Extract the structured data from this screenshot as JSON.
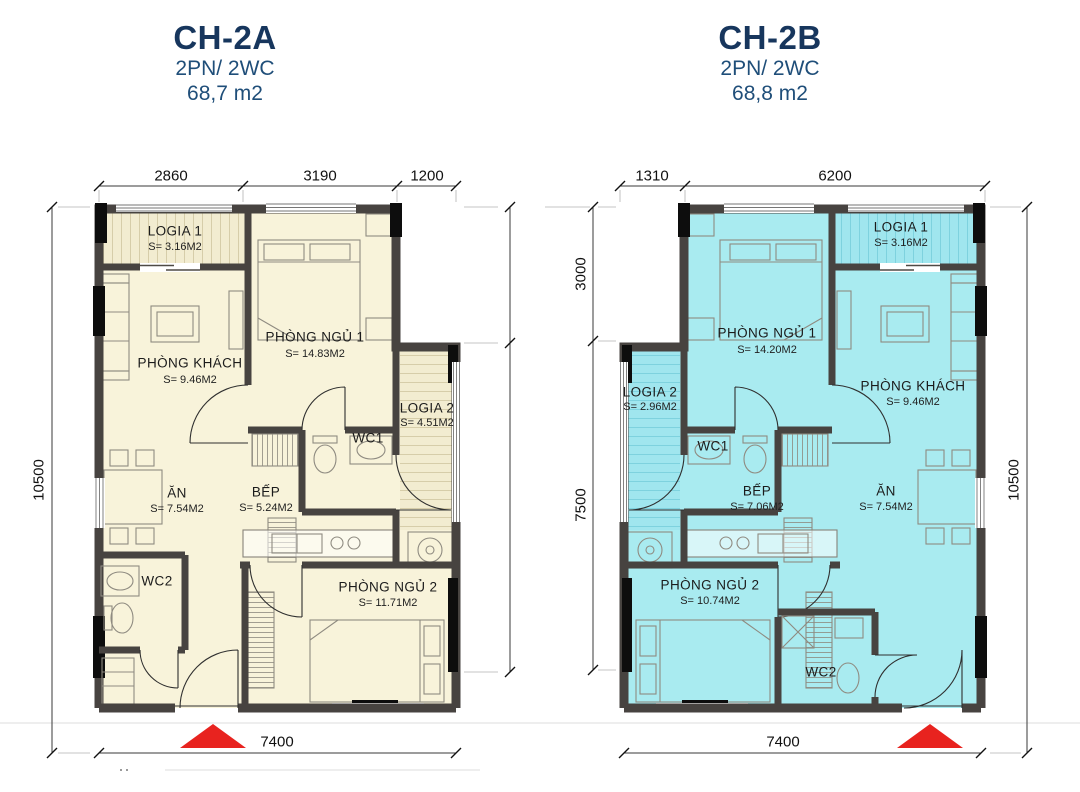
{
  "colors": {
    "title_navy": "#17365d",
    "subtitle_navy": "#1f4e79",
    "floor_cream": "#f8f3da",
    "floor_cyan": "#a9ebf0",
    "wall_dark": "#474340",
    "column_black": "#0d0d0d",
    "arrow_red": "#e8231f",
    "dim_color": "#3a3a3a"
  },
  "plans": [
    {
      "title": "CH-2A",
      "subtitle": "2PN/ 2WC",
      "area_label": "68,7 m2",
      "dims": {
        "top": [
          "2860",
          "3190",
          "1200"
        ],
        "side": "10500",
        "bottom": "7400"
      },
      "rooms": [
        {
          "name": "LOGIA 1",
          "area": "S= 3.16M2"
        },
        {
          "name": "PHÒNG NGỦ 1",
          "area": "S= 14.83M2"
        },
        {
          "name": "PHÒNG KHÁCH",
          "area": "S= 9.46M2"
        },
        {
          "name": "LOGIA 2",
          "area": "S= 4.51M2"
        },
        {
          "name": "WC1",
          "area": ""
        },
        {
          "name": "ĂN",
          "area": "S= 7.54M2"
        },
        {
          "name": "BẾP",
          "area": "S= 5.24M2"
        },
        {
          "name": "WC2",
          "area": ""
        },
        {
          "name": "PHÒNG NGỦ 2",
          "area": "S= 11.71M2"
        }
      ]
    },
    {
      "title": "CH-2B",
      "subtitle": "2PN/ 2WC",
      "area_label": "68,8 m2",
      "dims": {
        "top": [
          "1310",
          "6200"
        ],
        "side_left": [
          "3000",
          "7500"
        ],
        "side": "10500",
        "bottom": "7400"
      },
      "rooms": [
        {
          "name": "LOGIA 1",
          "area": "S= 3.16M2"
        },
        {
          "name": "PHÒNG NGỦ 1",
          "area": "S= 14.20M2"
        },
        {
          "name": "PHÒNG KHÁCH",
          "area": "S= 9.46M2"
        },
        {
          "name": "LOGIA 2",
          "area": "S= 2.96M2"
        },
        {
          "name": "WC1",
          "area": ""
        },
        {
          "name": "BẾP",
          "area": "S= 7.06M2"
        },
        {
          "name": "ĂN",
          "area": "S= 7.54M2"
        },
        {
          "name": "WC2",
          "area": ""
        },
        {
          "name": "PHÒNG NGỦ 2",
          "area": "S= 10.74M2"
        }
      ]
    }
  ]
}
